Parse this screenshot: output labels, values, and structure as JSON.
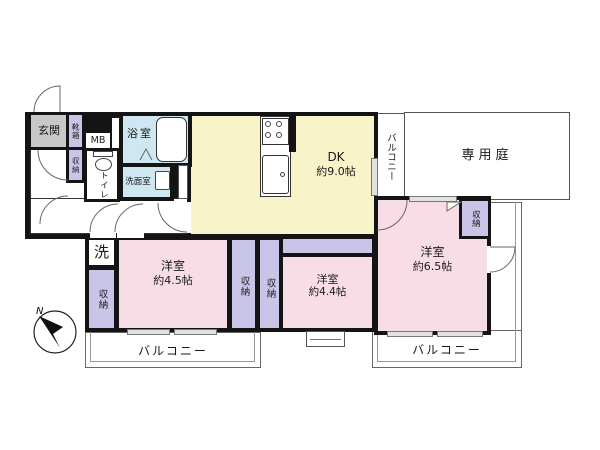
{
  "title": "間取り図",
  "colors": {
    "wall": "#141414",
    "room_pink": "#f8dde7",
    "dk_yellow": "#f8f3c8",
    "closet_purple": "#c9c5e8",
    "bath_blue": "#cfe7f1",
    "genkan_gray": "#c8c8c8"
  },
  "rooms": {
    "genkan": {
      "label": "玄関"
    },
    "shoebox": {
      "label": "靴箱"
    },
    "mb": {
      "label": "MB"
    },
    "hall_closet": {
      "label": "収納"
    },
    "toilet": {
      "label": "トイレ"
    },
    "bath": {
      "label": "浴室"
    },
    "washroom": {
      "label": "洗面室"
    },
    "dk": {
      "label": "DK",
      "size": "約9.0帖"
    },
    "garden": {
      "label": "専用庭"
    },
    "balcony_side": {
      "label": "バルコニー"
    },
    "laundry": {
      "label": "洗"
    },
    "closet_a": {
      "label": "収納"
    },
    "room45": {
      "label": "洋室",
      "size": "約4.5帖"
    },
    "closet_b": {
      "label": "収納"
    },
    "closet_c": {
      "label": "収納"
    },
    "room44": {
      "label": "洋室",
      "size": "約4.4帖"
    },
    "room65": {
      "label": "洋室",
      "size": "約6.5帖"
    },
    "closet_d": {
      "label": "収納"
    },
    "balcony_left": {
      "label": "バルコニー"
    },
    "balcony_right": {
      "label": "バルコニー"
    }
  },
  "compass": {
    "label": "N"
  }
}
